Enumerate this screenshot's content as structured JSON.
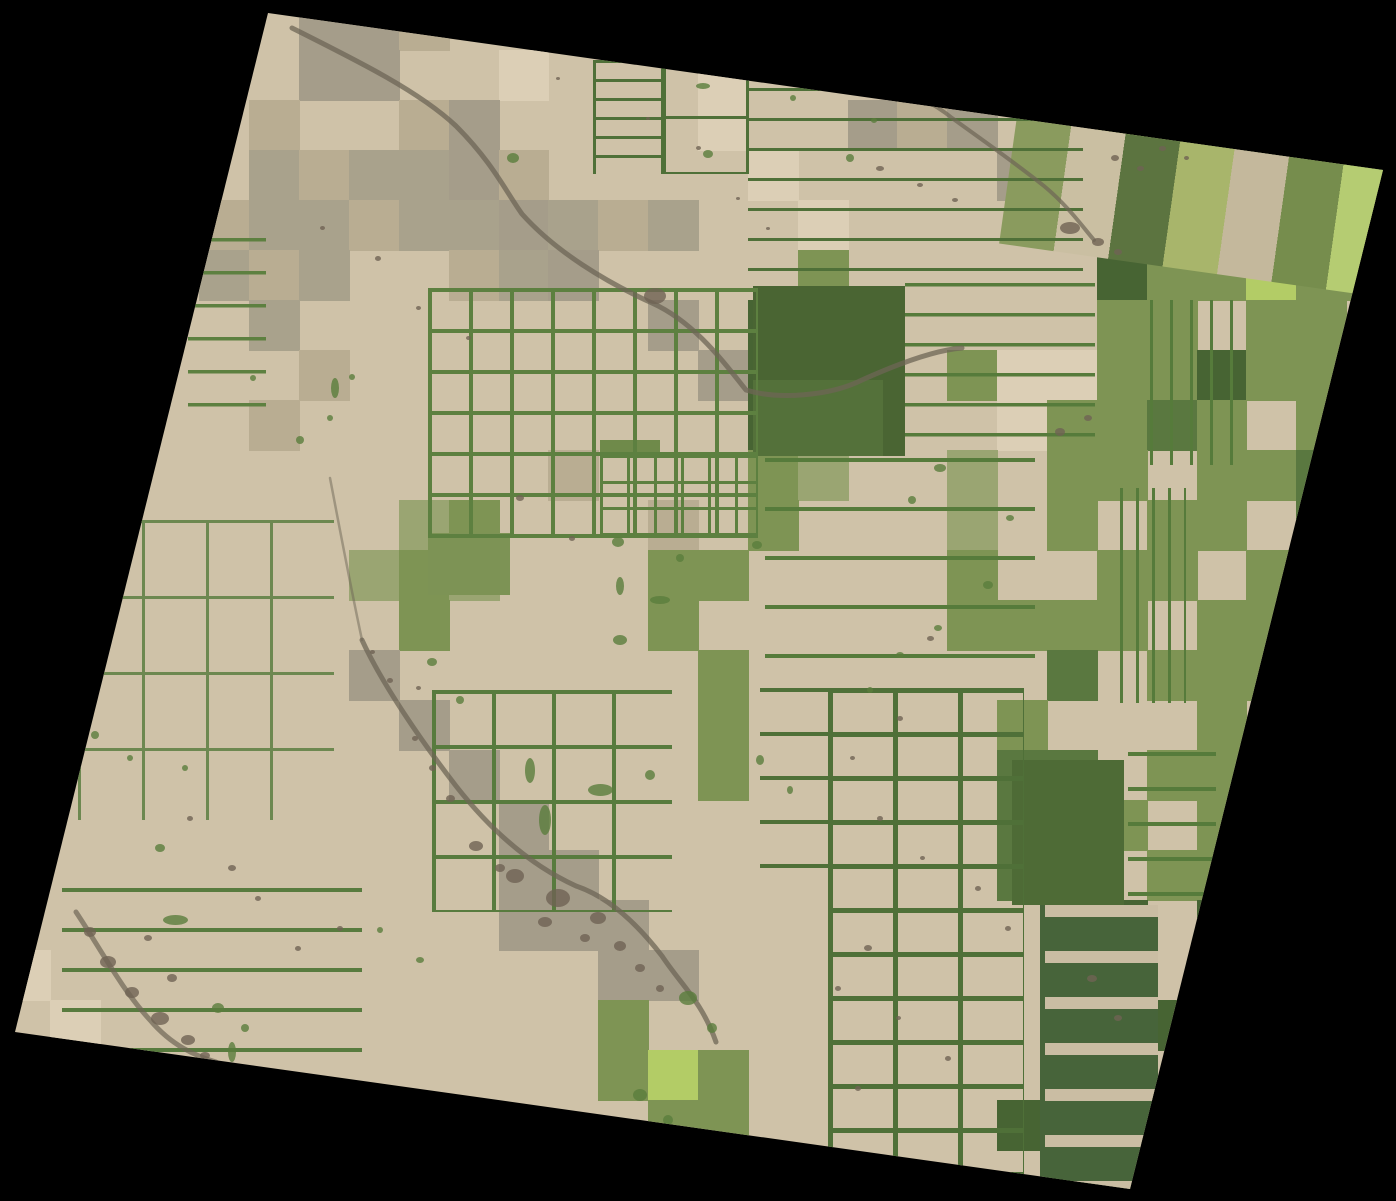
{
  "scene": {
    "description": "Satellite scene of agricultural field parcels, rotated on black background",
    "canvas": {
      "width": 1396,
      "height": 1200,
      "background": "#000000"
    },
    "corners": [
      [
        268,
        13
      ],
      [
        1383,
        170
      ],
      [
        1130,
        1189
      ],
      [
        15,
        1032
      ]
    ],
    "base_char": "T",
    "palette": {
      "T": "#cfc2a8",
      "L": "#dccfb6",
      "K": "#b9ad92",
      "O": "#a9a28c",
      "W": "#a59d8a",
      "G": "#7e9454",
      "M": "#9aa572",
      "D": "#5a7840",
      "E": "#476433",
      "B": "#b3cc66",
      "Y": "#a9bd6e"
    },
    "grid": {
      "cols": 28,
      "rows": 24,
      "cell_w": 49.857,
      "cell_h": 50,
      "rows_data": [
        "TTTTTTWWKTTTTTTTTTTTTTTTTTTT",
        "TTTTTTWWTTLTTTLTTTTTTTTTTTTT",
        "TTTTTKTTKWTTTTLTTWKWTTBGGTTT",
        "TTTTTOKOOWKTTTTLTTTTWTGGTGGE",
        "TTTTKOOKOOWOKOTTLTTTTTGTLGEG",
        "TTTTOKOTTKOWTTTTGTTTTTEGGBGG",
        "TTTTTOTTTTTTTWTEEDTTTTGGTGGT",
        "TTTTTTKTTTTTTTWEEETGLLGGEGGE",
        "TTTTTKTTTTTTTTTEDETTLGGDGTGG",
        "TTTTTTTTTTTKTTTGMTTMTGGTGGDT",
        "TTTTTTTTMGTTTKTGTTTMTGTGGTDG",
        "TTTTTTTMGMTTTGGTTTTGTTGGTGGD",
        "TTTTTTTTGTTTTGTTTTTGGGGTGGGT",
        "TTTTTTTWTTTTTTGTTTTTTDTGGGTG",
        "TTTTTTTTWTTTTTGTTTTTGTTTGTGT",
        "TTTTTTTTTWTTTTGTTTTTDDTGGGTG",
        "TTTTTTTTTTWTTTTTTTTTDDGTGTGT",
        "TTTTTTTTTTWWTTTTTTTTDDTGGTGT",
        "TTTTTTTTTTWWWTTTTTTTTDETETTT",
        "LTTTTTTTTTTTWWTTTTTTTEDTETTT",
        "TLTTTTTTTTTTGTTTTTTTTEDETTTT",
        "TTLTTTTTTTTTGBGTTTTTTDETTTTT",
        "TTTTTTTTTTTTTGGTTTTTEDTTTTTT",
        "TTTTTTTTTTTTTTTTTTTTTETTTTTT"
      ]
    },
    "blocks": [
      {
        "x": 753,
        "y": 286,
        "w": 152,
        "h": 170,
        "c": "#4a6533"
      },
      {
        "x": 753,
        "y": 380,
        "w": 130,
        "h": 76,
        "c": "#54713a"
      },
      {
        "x": 1012,
        "y": 760,
        "w": 112,
        "h": 145,
        "c": "#4e6b36"
      },
      {
        "x": 1040,
        "y": 905,
        "w": 118,
        "h": 285,
        "c": "#47643a"
      },
      {
        "x": 428,
        "y": 533,
        "w": 82,
        "h": 62,
        "c": "#7d9355"
      },
      {
        "x": 600,
        "y": 440,
        "w": 60,
        "h": 18,
        "c": "#6f8a4a"
      }
    ],
    "diag_bands": [
      {
        "x": 1020,
        "y": 95,
        "w": 430,
        "h": 150,
        "rot": 8,
        "pitch": 55,
        "colors": [
          "#8a9b5e",
          "#cabfa2",
          "#5c7440",
          "#a8b56b",
          "#c4b89c",
          "#768d4d",
          "#b5cc72",
          "#8a9b5e"
        ]
      }
    ],
    "line_overlays": [
      {
        "x": 428,
        "y": 288,
        "w": 330,
        "h": 250,
        "px": 41,
        "py": 41,
        "t": 4,
        "c": "#5d8040"
      },
      {
        "x": 600,
        "y": 455,
        "w": 158,
        "h": 80,
        "px": 27,
        "py": 26,
        "t": 3,
        "c": "#5d8040"
      },
      {
        "x": 432,
        "y": 690,
        "w": 240,
        "h": 222,
        "px": 60,
        "py": 55,
        "t": 4,
        "c": "#587b3e"
      },
      {
        "x": 78,
        "y": 520,
        "w": 256,
        "h": 300,
        "px": 64,
        "py": 76,
        "t": 3,
        "c": "#6d8850"
      },
      {
        "x": 593,
        "y": 60,
        "w": 72,
        "h": 114,
        "px": 68,
        "py": 19,
        "t": 3,
        "c": "#4f7038"
      },
      {
        "x": 663,
        "y": 60,
        "w": 86,
        "h": 114,
        "px": 83,
        "py": 56,
        "t": 3,
        "c": "#4f7038"
      },
      {
        "x": 748,
        "y": 88,
        "w": 335,
        "h": 205,
        "px": 0,
        "py": 30,
        "t": 3,
        "c": "#4f7038"
      },
      {
        "x": 905,
        "y": 283,
        "w": 190,
        "h": 178,
        "px": 0,
        "py": 30,
        "t": 3.5,
        "c": "#567b3b"
      },
      {
        "x": 765,
        "y": 458,
        "w": 270,
        "h": 242,
        "px": 0,
        "py": 49,
        "t": 4,
        "c": "#567b3b"
      },
      {
        "x": 828,
        "y": 688,
        "w": 196,
        "h": 505,
        "px": 65,
        "py": 44,
        "t": 5,
        "c": "#4f7038"
      },
      {
        "x": 760,
        "y": 688,
        "w": 68,
        "h": 192,
        "px": 0,
        "py": 44,
        "t": 4,
        "c": "#4f7038"
      },
      {
        "x": 188,
        "y": 238,
        "w": 78,
        "h": 186,
        "px": 0,
        "py": 33,
        "t": 3.5,
        "c": "#5d8040"
      },
      {
        "x": 62,
        "y": 888,
        "w": 300,
        "h": 166,
        "px": 0,
        "py": 40,
        "t": 4,
        "c": "#587b3e"
      },
      {
        "x": 1120,
        "y": 488,
        "w": 66,
        "h": 215,
        "px": 16,
        "py": 0,
        "t": 3,
        "c": "#567b3b"
      },
      {
        "x": 1150,
        "y": 300,
        "w": 86,
        "h": 165,
        "px": 20,
        "py": 0,
        "t": 3,
        "c": "#567b3b"
      },
      {
        "x": 1045,
        "y": 905,
        "w": 113,
        "h": 288,
        "px": 0,
        "py": 46,
        "t": 12,
        "c": "#cabda3"
      },
      {
        "x": 1128,
        "y": 752,
        "w": 88,
        "h": 150,
        "px": 0,
        "py": 35,
        "t": 4,
        "c": "#567b3b"
      }
    ],
    "streams": {
      "color": "#6e6555",
      "paths": [
        {
          "d": "M 292 28 C 360 62 420 92 456 126 C 492 162 505 190 522 214 C 556 252 606 282 652 303 C 694 322 722 360 746 390 C 778 400 830 396 862 380 C 902 362 936 350 962 348",
          "w": 5,
          "o": 0.75
        },
        {
          "d": "M 828 62 C 882 86 918 90 952 118 C 988 144 1014 162 1044 186 C 1068 206 1082 226 1094 240",
          "w": 4,
          "o": 0.7
        },
        {
          "d": "M 362 640 C 382 684 422 742 456 786 C 492 832 532 866 576 886 C 612 898 642 930 662 956 C 682 986 702 1002 716 1042",
          "w": 5,
          "o": 0.75
        },
        {
          "d": "M 330 478 C 340 530 350 584 362 640",
          "w": 2.5,
          "o": 0.5
        },
        {
          "d": "M 76 912 C 100 948 122 990 150 1020 C 172 1046 196 1056 216 1062",
          "w": 5,
          "o": 0.7
        }
      ]
    },
    "dark_spots": {
      "color": "#6f6354",
      "items": [
        [
          655,
          296,
          22,
          16
        ],
        [
          520,
          498,
          8,
          6
        ],
        [
          572,
          538,
          6,
          5
        ],
        [
          476,
          846,
          14,
          10
        ],
        [
          515,
          876,
          18,
          14
        ],
        [
          558,
          898,
          24,
          18
        ],
        [
          598,
          918,
          16,
          12
        ],
        [
          545,
          922,
          14,
          10
        ],
        [
          620,
          946,
          12,
          10
        ],
        [
          640,
          968,
          10,
          8
        ],
        [
          660,
          988,
          8,
          7
        ],
        [
          585,
          938,
          10,
          8
        ],
        [
          500,
          868,
          10,
          8
        ],
        [
          450,
          798,
          9,
          7
        ],
        [
          432,
          768,
          7,
          6
        ],
        [
          415,
          738,
          6,
          5
        ],
        [
          390,
          680,
          6,
          5
        ],
        [
          372,
          652,
          5,
          4
        ],
        [
          90,
          932,
          12,
          10
        ],
        [
          108,
          962,
          16,
          12
        ],
        [
          132,
          992,
          14,
          11
        ],
        [
          160,
          1018,
          18,
          13
        ],
        [
          188,
          1040,
          14,
          10
        ],
        [
          148,
          938,
          8,
          6
        ],
        [
          172,
          978,
          10,
          8
        ],
        [
          205,
          1055,
          10,
          7
        ],
        [
          1070,
          228,
          20,
          12
        ],
        [
          1098,
          242,
          12,
          8
        ],
        [
          1118,
          252,
          8,
          6
        ],
        [
          1115,
          158,
          8,
          6
        ],
        [
          1140,
          168,
          7,
          5
        ],
        [
          1162,
          148,
          7,
          5
        ],
        [
          1186,
          158,
          5,
          4
        ],
        [
          1208,
          142,
          5,
          4
        ],
        [
          880,
          168,
          8,
          5
        ],
        [
          920,
          185,
          6,
          4
        ],
        [
          955,
          200,
          6,
          4
        ],
        [
          1060,
          432,
          10,
          8
        ],
        [
          1088,
          418,
          8,
          6
        ],
        [
          930,
          638,
          7,
          5
        ],
        [
          900,
          718,
          6,
          5
        ],
        [
          852,
          758,
          5,
          4
        ],
        [
          880,
          818,
          6,
          5
        ],
        [
          922,
          858,
          5,
          4
        ],
        [
          978,
          888,
          6,
          5
        ],
        [
          1008,
          928,
          6,
          5
        ],
        [
          868,
          948,
          8,
          6
        ],
        [
          838,
          988,
          6,
          5
        ],
        [
          898,
          1018,
          5,
          4
        ],
        [
          948,
          1058,
          6,
          5
        ],
        [
          858,
          1088,
          6,
          5
        ],
        [
          1092,
          978,
          10,
          7
        ],
        [
          1118,
          1018,
          8,
          6
        ],
        [
          232,
          868,
          8,
          6
        ],
        [
          190,
          818,
          6,
          5
        ],
        [
          258,
          898,
          6,
          5
        ],
        [
          340,
          928,
          6,
          5
        ],
        [
          418,
          308,
          5,
          4
        ],
        [
          468,
          338,
          5,
          4
        ],
        [
          378,
          258,
          6,
          5
        ],
        [
          322,
          228,
          5,
          4
        ],
        [
          698,
          148,
          5,
          4
        ],
        [
          648,
          118,
          4,
          3
        ],
        [
          558,
          78,
          4,
          3
        ],
        [
          738,
          198,
          4,
          3
        ],
        [
          768,
          228,
          4,
          3
        ],
        [
          298,
          948,
          6,
          5
        ],
        [
          418,
          688,
          5,
          4
        ]
      ]
    },
    "green_spots": {
      "color": "#5a7d3c",
      "items": [
        [
          513,
          158,
          12,
          10
        ],
        [
          708,
          154,
          10,
          8
        ],
        [
          850,
          158,
          8,
          8
        ],
        [
          793,
          98,
          6,
          6
        ],
        [
          874,
          120,
          6,
          5
        ],
        [
          703,
          86,
          14,
          6
        ],
        [
          335,
          388,
          8,
          20
        ],
        [
          352,
          377,
          6,
          6
        ],
        [
          300,
          440,
          8,
          8
        ],
        [
          618,
          542,
          12,
          10
        ],
        [
          680,
          558,
          8,
          8
        ],
        [
          757,
          545,
          10,
          8
        ],
        [
          620,
          586,
          8,
          18
        ],
        [
          660,
          600,
          20,
          8
        ],
        [
          620,
          640,
          14,
          10
        ],
        [
          432,
          662,
          10,
          8
        ],
        [
          460,
          700,
          8,
          8
        ],
        [
          530,
          770,
          10,
          25
        ],
        [
          545,
          820,
          12,
          30
        ],
        [
          600,
          790,
          25,
          12
        ],
        [
          650,
          775,
          10,
          10
        ],
        [
          688,
          998,
          18,
          14
        ],
        [
          712,
          1028,
          10,
          10
        ],
        [
          640,
          1095,
          14,
          12
        ],
        [
          668,
          1120,
          10,
          10
        ],
        [
          175,
          920,
          25,
          10
        ],
        [
          218,
          1008,
          12,
          10
        ],
        [
          245,
          1028,
          8,
          8
        ],
        [
          232,
          1052,
          8,
          20
        ],
        [
          282,
          1075,
          10,
          10
        ],
        [
          160,
          848,
          10,
          8
        ],
        [
          95,
          735,
          8,
          8
        ],
        [
          130,
          758,
          6,
          6
        ],
        [
          185,
          768,
          6,
          6
        ],
        [
          940,
          468,
          12,
          8
        ],
        [
          912,
          500,
          8,
          8
        ],
        [
          1010,
          518,
          8,
          6
        ],
        [
          988,
          585,
          10,
          8
        ],
        [
          938,
          628,
          8,
          6
        ],
        [
          330,
          418,
          6,
          6
        ],
        [
          253,
          378,
          6,
          6
        ],
        [
          900,
          655,
          8,
          6
        ],
        [
          870,
          690,
          6,
          6
        ],
        [
          420,
          960,
          8,
          6
        ],
        [
          380,
          930,
          6,
          6
        ],
        [
          760,
          760,
          8,
          10
        ],
        [
          790,
          790,
          6,
          8
        ],
        [
          940,
          96,
          7,
          6
        ],
        [
          1005,
          108,
          6,
          5
        ]
      ]
    }
  }
}
